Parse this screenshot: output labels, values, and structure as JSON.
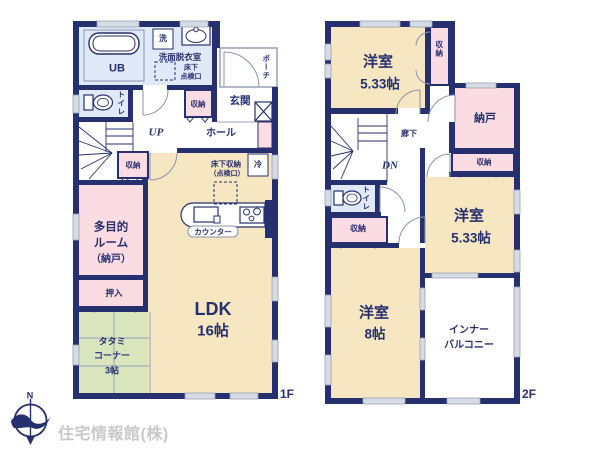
{
  "floor1": {
    "label": "1F",
    "ub": "UB",
    "washer": "洗",
    "washroom": "洗面脱衣室",
    "hatch_l1": "床下",
    "hatch_l2": "点検口",
    "toilet": "トイレ",
    "porch": "ポーチ",
    "entrance": "玄関",
    "hall": "ホール",
    "up": "UP",
    "storage_hall": "収納",
    "storage_stairs": "収納",
    "underfloor_l1": "床下収納",
    "underfloor_l2": "（点検口）",
    "fridge": "冷",
    "counter": "カウンター",
    "multi_l1": "多目的",
    "multi_l2": "ルーム",
    "multi_l3": "（納戸）",
    "oshiire": "押入",
    "tatami_l1": "タタミ",
    "tatami_l2": "コーナー",
    "tatami_size": "3帖",
    "ldk": "LDK",
    "ldk_size": "16帖"
  },
  "floor2": {
    "label": "2F",
    "room_a": "洋室",
    "room_a_size": "5.33帖",
    "storage_a": "収納",
    "nando": "納戸",
    "corridor": "廊下",
    "dn": "DN",
    "toilet": "トイレ",
    "storage_mid": "収納",
    "storage_strip": "収納",
    "room_b": "洋室",
    "room_b_size": "5.33帖",
    "room_c": "洋室",
    "room_c_size": "8帖",
    "balcony_l1": "インナー",
    "balcony_l2": "バルコニー"
  },
  "compass": {
    "north": "N"
  },
  "watermark": "住宅情報館(株)",
  "colors": {
    "wall_navy": "#27306e",
    "room_cream": "#f6e7c2",
    "room_pink": "#fbdce2",
    "room_blue": "#dfe9f7",
    "room_green": "#dbe5bd",
    "window_gray": "#d7dbe4",
    "line_gray": "#9aa0b5",
    "watermark_gray": "#c9c9c9"
  }
}
